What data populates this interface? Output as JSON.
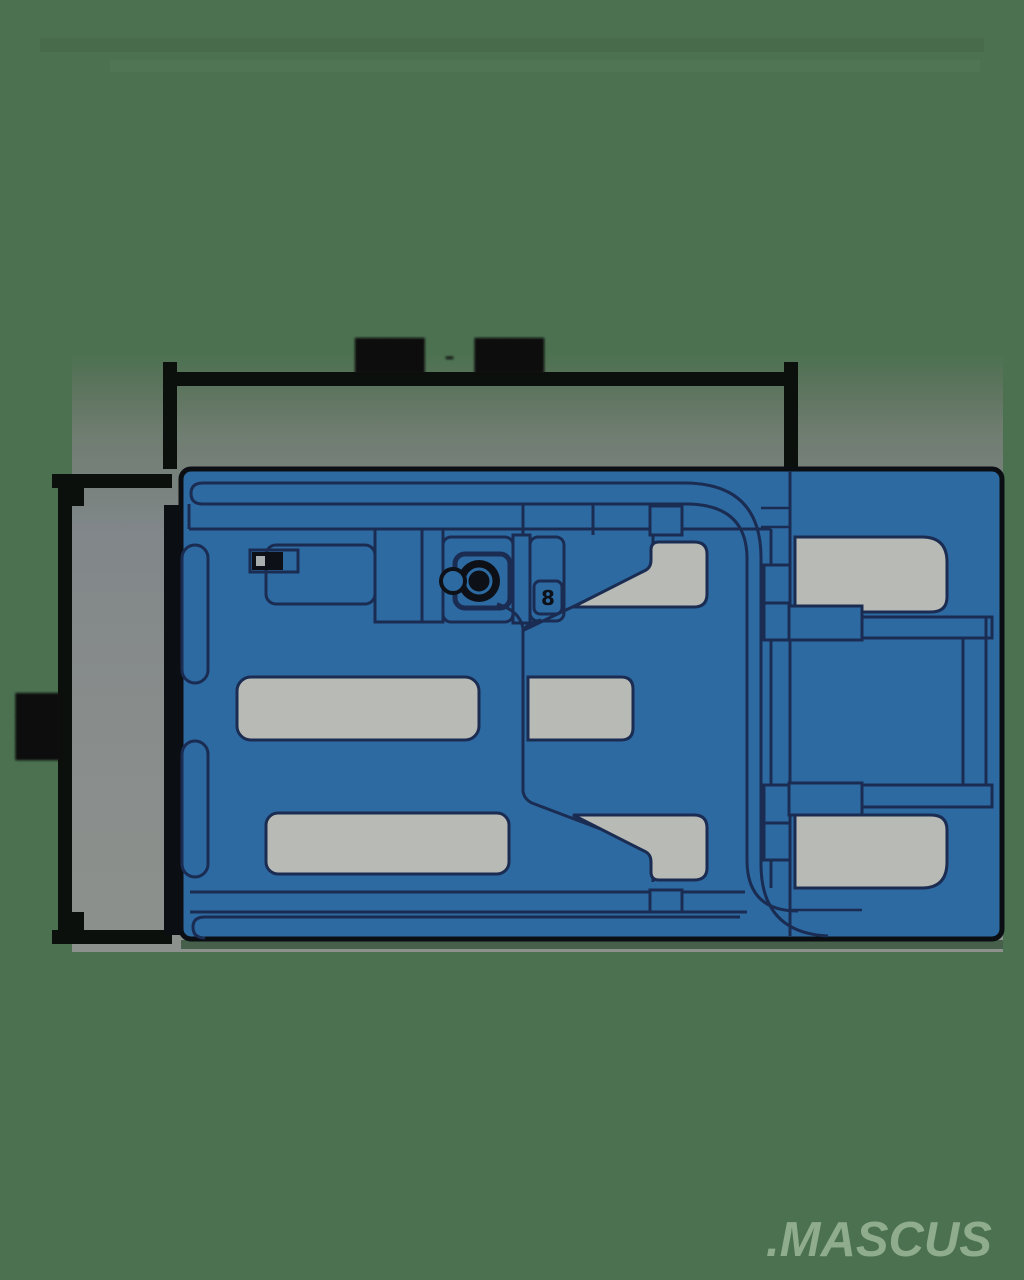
{
  "watermark": {
    "text": ".MASCUS"
  },
  "dimensions": {
    "width_label": "████ - ████",
    "height_label": "███"
  },
  "machine": {
    "type": "top-view technical drawing of machine",
    "console_badge": "8"
  },
  "colors": {
    "bg-green": "#4b7150",
    "panel-top": "#5a735b",
    "panel-mid": "#81878a",
    "panel-gray": "#8d918d",
    "machine-blue": "#2d6aa2",
    "navy": "#1b2c52",
    "outline-black": "#0b0e12",
    "part-gray": "#b7bab5",
    "dim-color": "#0c100c",
    "watermark-green": "#8fac8d",
    "steering-dark": "#0d1117",
    "shadow-green": "#39573f"
  }
}
